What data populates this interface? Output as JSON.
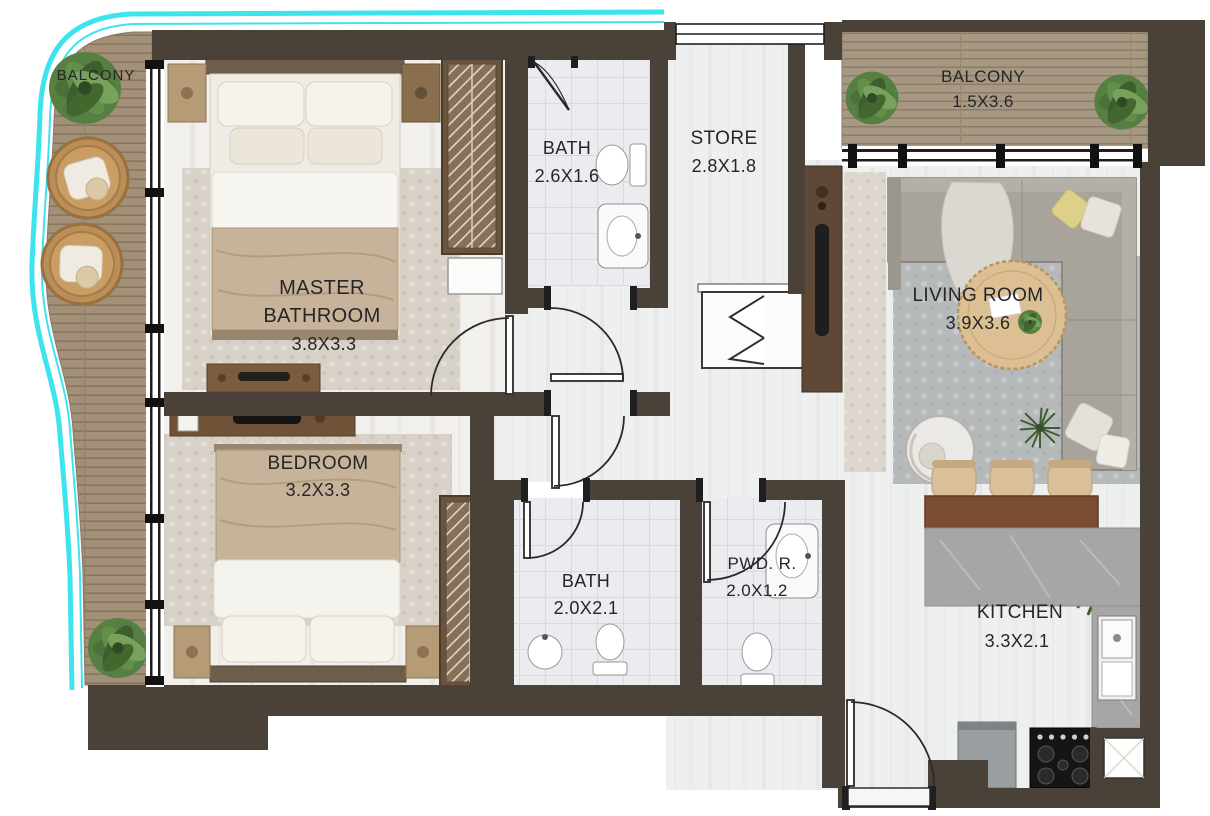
{
  "plan_type": "apartment-floor-plan",
  "colors": {
    "glass_edge_accent": "#3ee4ed",
    "wall": "#4a4138",
    "deck_wood": "#a29078",
    "floor_light": "#eef0f0",
    "rug_beige": "#d8d1c8",
    "rug_gray": "#b6b9ba",
    "island_wood": "#7b4e31",
    "counter_marble": "#a8a6a4",
    "plant_green": "#4c7038"
  },
  "rooms": [
    {
      "key": "balcony_left",
      "line1": "BALCONY",
      "dims": ""
    },
    {
      "key": "master_bedroom",
      "line1": "MASTER",
      "line2": "BATHROOM",
      "dims": "3.8X3.3"
    },
    {
      "key": "bath_top",
      "line1": "BATH",
      "dims": "2.6X1.6"
    },
    {
      "key": "store",
      "line1": "STORE",
      "dims": "2.8X1.8"
    },
    {
      "key": "balcony_top",
      "line1": "BALCONY",
      "dims": "1.5X3.6"
    },
    {
      "key": "living_room",
      "line1": "LIVING ROOM",
      "dims": "3.9X3.6"
    },
    {
      "key": "bedroom",
      "line1": "BEDROOM",
      "dims": "3.2X3.3"
    },
    {
      "key": "bath_bottom",
      "line1": "BATH",
      "dims": "2.0X2.1"
    },
    {
      "key": "powder_room",
      "line1": "PWD. R.",
      "dims": "2.0X1.2"
    },
    {
      "key": "kitchen",
      "line1": "KITCHEN",
      "dims": "3.3X2.1"
    }
  ]
}
